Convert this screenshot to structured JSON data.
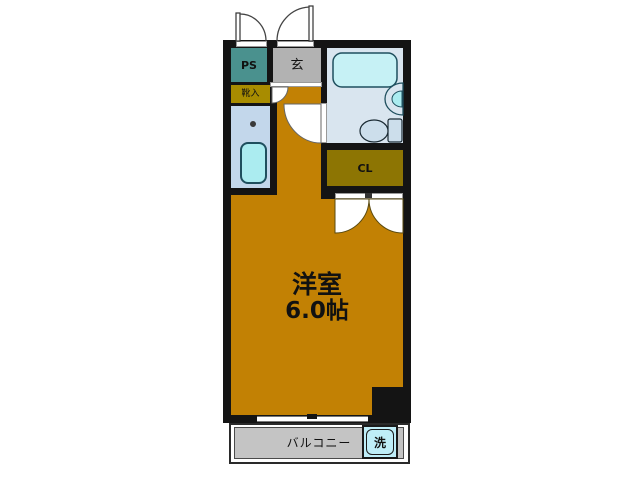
{
  "title": "apartment-floorplan",
  "rooms": {
    "main": {
      "label": "洋室",
      "size": "6.0帖"
    },
    "entrance": {
      "label": "玄"
    },
    "pipe_space": {
      "label": "PS"
    },
    "shoe_cabinet": {
      "label": "靴入"
    },
    "closet": {
      "label": "CL"
    },
    "balcony": {
      "label": "バルコニー"
    },
    "washer": {
      "label": "洗"
    }
  },
  "colors": {
    "wall": "#141414",
    "main_room": "#c28104",
    "pipe_space": "#4a918e",
    "entrance": "#b2b2b2",
    "shoe_cabinet": "#a88c00",
    "closet": "#8d7503",
    "cl_text": "#4a3711",
    "bathroom_floor": "#d9e5ef",
    "kitchen_floor": "#c3d7eb",
    "fixture_cyan": "#abecf0",
    "tub_cyan": "#c6f1f5",
    "washer_cyan": "#bfeef8",
    "balcony_gray": "#c4c4c4"
  }
}
